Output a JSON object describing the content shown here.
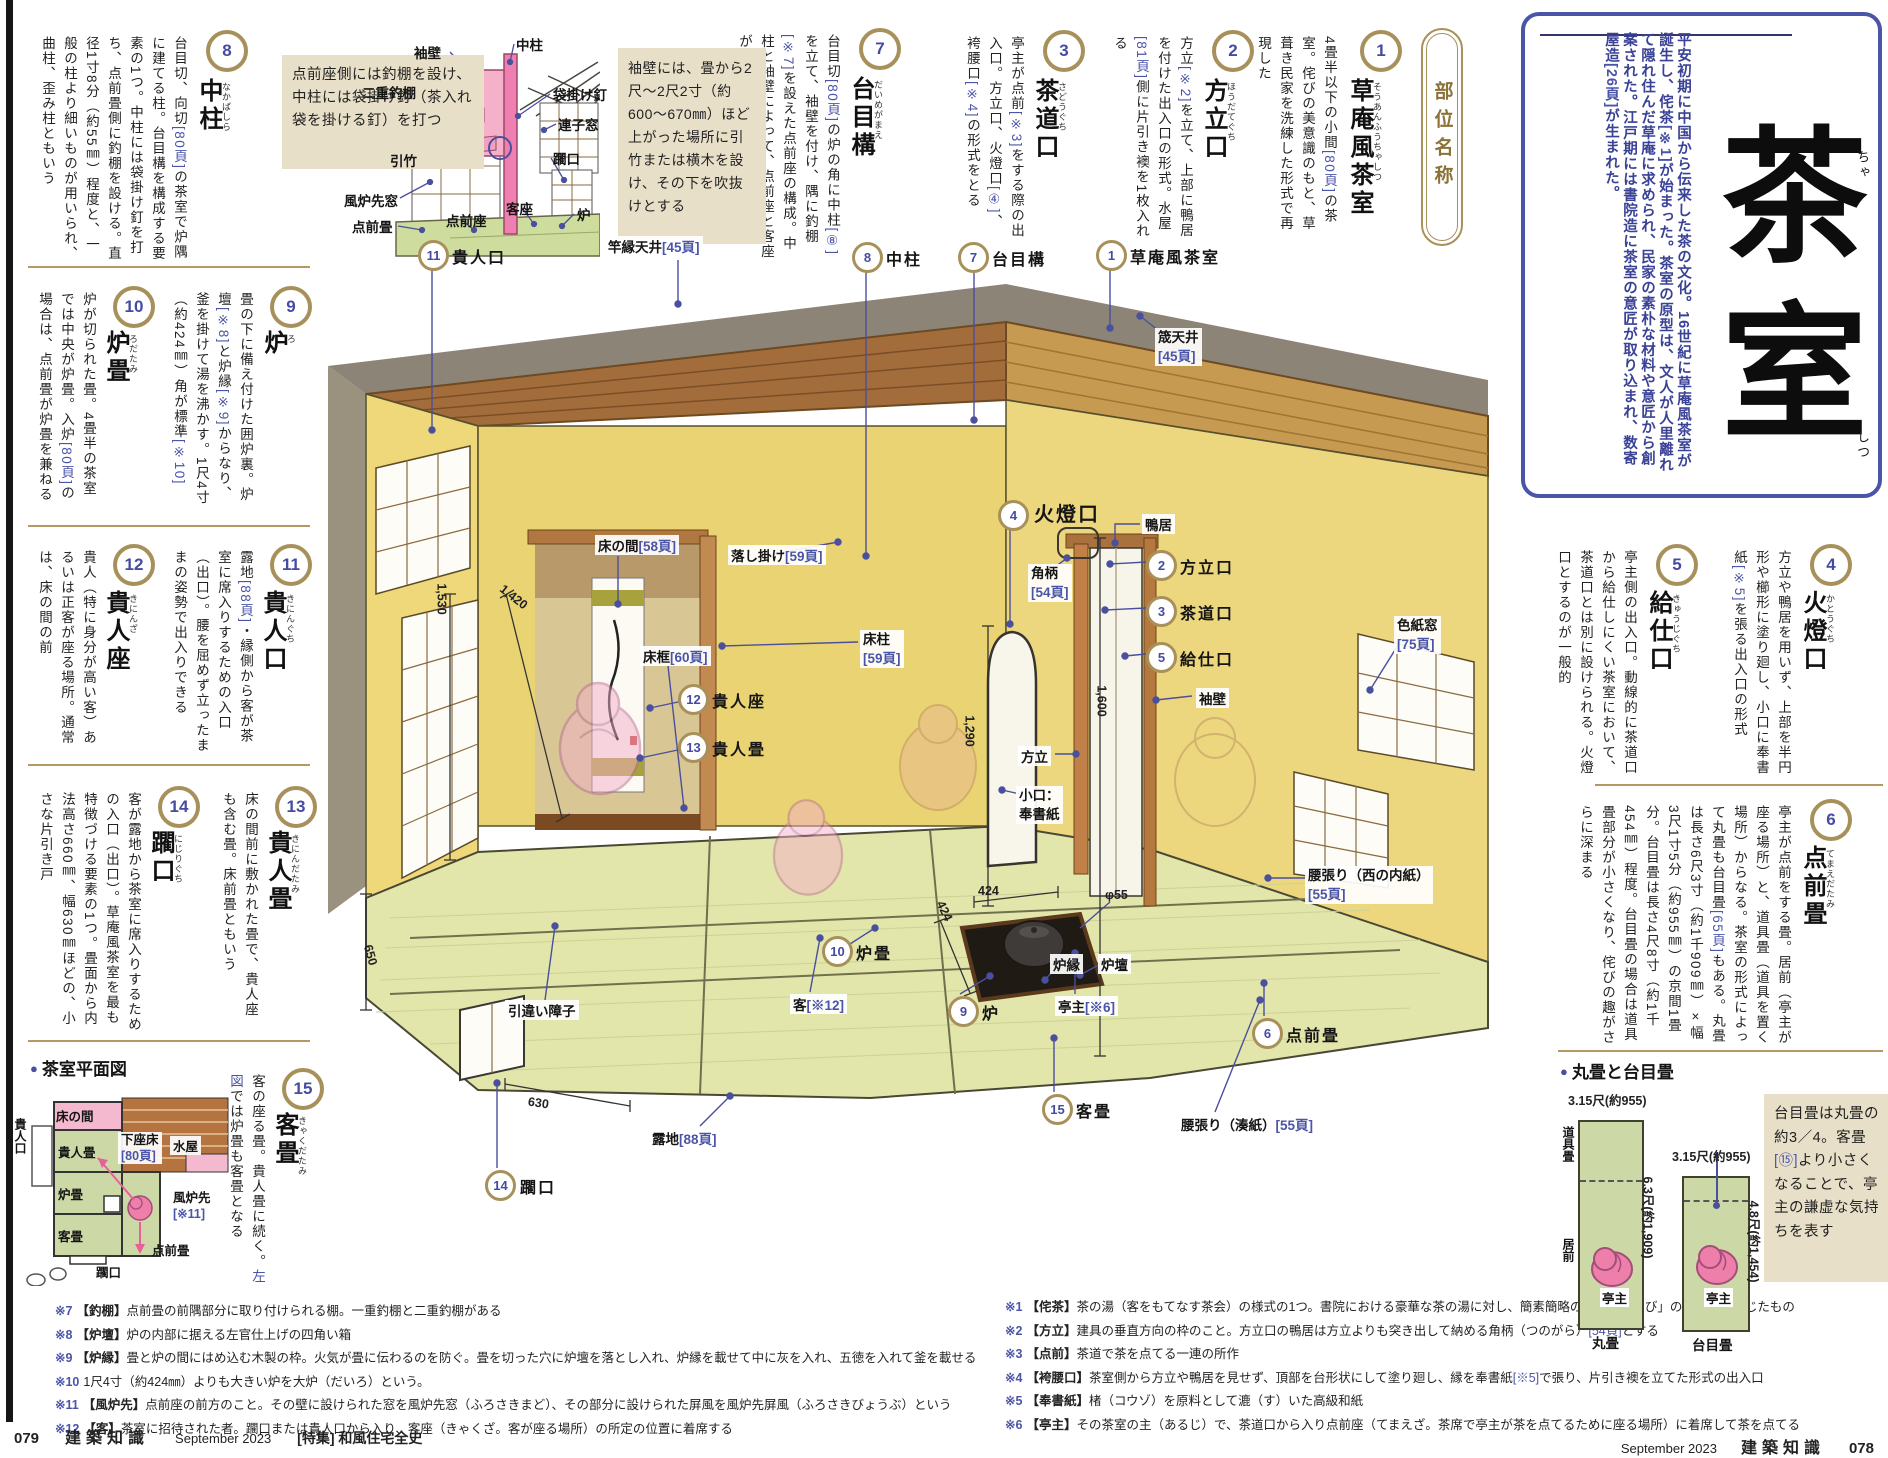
{
  "accent_words": [
    "左図"
  ],
  "header": {
    "badge": "部位名称",
    "title": "茶室",
    "title_kana_1": "ちゃ",
    "title_kana_2": "しつ",
    "intro": "平安初期に中国から伝来した茶の文化。16世紀に草庵風茶室が誕生し、侘茶[※1]が始まった。茶室の原型は、文人が人里離れて隠れ住んだ草庵に求められ、民家の素朴な材料や意匠から創案された。江戸期には書院造に茶室の意匠が取り込まれ、数寄屋造[26頁]が生まれた。"
  },
  "items": [
    {
      "num": "1",
      "name": "草庵風茶室",
      "kana": "そうあんふうちゃしつ",
      "body": "4畳半以下の小間[80頁]の茶室。侘びの美意識のもと、草葺き民家を洗練した形式で再現した"
    },
    {
      "num": "2",
      "name": "方立口",
      "kana": "ほうだてぐち",
      "body": "方立[※2]を立て、上部に鴨居を付けた出入口の形式。水屋[81頁]側に片引き襖を1枚入れる"
    },
    {
      "num": "3",
      "name": "茶道口",
      "kana": "さどうぐち",
      "body": "亭主が点前[※3]をする際の出入口。方立口、火燈口[④]、袴腰口[※4]の形式をとる"
    },
    {
      "num": "4",
      "name": "火燈口",
      "kana": "かとうぐち",
      "body": "方立や鴨居を用いず、上部を半円形や櫛形に塗り廻し、小口に奉書紙[※5]を張る出入口の形式"
    },
    {
      "num": "5",
      "name": "給仕口",
      "kana": "きゅうじぐち",
      "body": "亭主側の出入口。動線的に茶道口から給仕しにくい茶室において、茶道口とは別に設けられる。火燈口とするのが一般的"
    },
    {
      "num": "6",
      "name": "点前畳",
      "kana": "てまえだたみ",
      "body": "亭主が点前をする畳。居前（亭主が座る場所）と、道具畳（道具を置く場所）からなる。茶室の形式によって丸畳も台目畳[65頁]もある。丸畳は長さ6尺3寸（約1千909㎜）×幅3尺1寸5分（約955㎜）の京間1畳分。台目畳は長さ4尺8寸（約1千454㎜）程度。台目畳の場合は道具畳部分が小さくなり、侘びの趣がさらに深まる"
    },
    {
      "num": "7",
      "name": "台目構",
      "kana": "だいめがまえ",
      "body": "台目切[80頁]の炉の角に中柱[⑧]を立て、袖壁を付け、隅に釣棚[※7]を設えた点前座の構成。中柱と袖壁によって、点前座と客座が緩やかに隔てられる"
    },
    {
      "num": "8",
      "name": "中柱",
      "kana": "なかばしら",
      "body": "台目切、向切[80頁]の茶室で炉隅に建てる柱。台目構を構成する要素の1つ。中柱には袋掛け釘を打ち、点前畳側に釣棚を設ける。直径1寸8分（約55㎜）程度と、一般の柱より細いものが用いられ、曲柱、歪み柱ともいう"
    },
    {
      "num": "9",
      "name": "炉",
      "kana": "ろ",
      "body": "畳の下に備え付けた囲炉裏。炉壇[※8]と炉縁[※9]からなり、釜を掛けて湯を沸かす。1尺4寸（約424㎜）角が標準[※10]"
    },
    {
      "num": "10",
      "name": "炉畳",
      "kana": "ろだたみ",
      "body": "炉が切られた畳。4畳半の茶室では中央が炉畳。入炉[80頁]の場合は、点前畳が炉畳を兼ねる"
    },
    {
      "num": "11",
      "name": "貴人口",
      "kana": "きにんぐち",
      "body": "露地[88頁]・縁側から客が茶室に席入りするための入口（出口）。腰を屈めず立ったままの姿勢で出入りできる"
    },
    {
      "num": "12",
      "name": "貴人座",
      "kana": "きにんざ",
      "body": "貴人（特に身分が高い客）あるいは正客が座る場所。通常は、床の間の前"
    },
    {
      "num": "13",
      "name": "貴人畳",
      "kana": "きにんだたみ",
      "body": "床の間前に敷かれた畳で、貴人座も含む畳。床前畳ともいう"
    },
    {
      "num": "14",
      "name": "躙口",
      "kana": "にじりぐち",
      "body": "客が露地から茶室に席入りするための入口（出口）。草庵風茶室を最も特徴づける要素の1つ。畳面から内法高さ660㎜、幅630㎜ほどの、小さな片引き戸"
    },
    {
      "num": "15",
      "name": "客畳",
      "kana": "きゃくだたみ",
      "body": "客の座る畳。貴人畳に続く。左図では炉畳も客畳となる"
    }
  ],
  "notes": {
    "sode": "袖壁には、畳から2尺〜2尺2寸（約600〜670㎜）ほど上がった場所に引竹または横木を設け、その下を吹抜けとする",
    "tsuridana": "点前座側には釣棚を設け、中柱には袋掛け釘（茶入れ袋を掛ける釘）を打つ",
    "daime": "台目畳は丸畳の約3／4。客畳[⑮]より小さくなることで、亭主の謙虚な気持ちを表す"
  },
  "mini": {
    "labels": {
      "sodekabe": "袖壁",
      "nakabashira": "中柱",
      "nijyu_tsuridana": "二重釣棚",
      "fukurokake_kugi": "袋掛け釘",
      "renjimado": "連子窓",
      "nijiriguchi": "躙口",
      "hikitake": "引竹",
      "furosaki_mado": "風炉先窓",
      "temaedatami": "点前畳",
      "temaeza": "点前座",
      "kyakuza": "客座",
      "ro": "炉"
    }
  },
  "main": {
    "labels": {
      "kinin_guchi": "貴人口",
      "saobuchi_tenjo": "竿縁天井[45頁]",
      "nakabashira": "中柱",
      "daimegamae": "台目構",
      "soanfu": "草庵風茶室",
      "osa_tenjo": "筬天井",
      "osa_ref": "[45頁]",
      "tokonoma": "床の間[58頁]",
      "otoshigake": "落し掛け[59頁]",
      "tokobashira": "床柱",
      "tokobashira_ref": "[59頁]",
      "tokogamachi": "床框[60頁]",
      "kininza": "貴人座",
      "kinindatami": "貴人畳",
      "hikichigai": "引違い障子",
      "kyaku": "客[※12]",
      "rodatami": "炉畳",
      "ro": "炉",
      "robuchi": "炉縁",
      "rodan": "炉壇",
      "teishu": "亭主[※6]",
      "nijiriguchi": "躙口",
      "roji": "露地[88頁]",
      "kyakudatami": "客畳",
      "koshibari_minato": "腰張り（湊紙）[55頁]",
      "temaedatami": "点前畳",
      "koshibari_nishi": "腰張り（西の内紙）",
      "koshibari_nishi_ref": "[55頁]",
      "shikishimado": "色紙窓",
      "shikishimado_ref": "[75頁]",
      "katoguchi": "火燈口",
      "kamoi": "鴨居",
      "tsunogara": "角柄",
      "tsunogara_ref": "[54頁]",
      "hodateguchi": "方立口",
      "sadoguchi": "茶道口",
      "kyujiguchi": "給仕口",
      "sodekabe": "袖壁",
      "hodate": "方立",
      "koguchi": "小口：",
      "koguchi2": "奉書紙",
      "dim_1420": "1,420",
      "dim_1530": "1,530",
      "dim_650": "650",
      "dim_1290": "1,290",
      "dim_1600": "1,600",
      "dim_424a": "424",
      "dim_424b": "424",
      "dim_phi55": "φ55",
      "dim_630": "630"
    }
  },
  "plan": {
    "bullet": "●",
    "title": "茶室平面図",
    "labels": {
      "kinin_guchi": "貴人口",
      "tokonoma": "床の間",
      "kinindatami": "貴人畳",
      "gezadoko": "下座床",
      "gezadoko_ref": "[80頁]",
      "mizuya": "水屋",
      "rodatami": "炉畳",
      "furosaki": "風炉先",
      "furosaki_ref": "[※11]",
      "kyakudatami": "客畳",
      "temaedatami": "点前畳",
      "nijiriguchi": "躙口"
    }
  },
  "tatami": {
    "bullet": "●",
    "title": "丸畳と台目畳",
    "w1": "3.15尺(約955)",
    "h1": "6.3尺(約1,909)",
    "w2": "3.15尺(約955)",
    "h2": "4.8尺(約1,454)",
    "dougu": "道具畳",
    "imae": "居前",
    "teishu1": "亭主",
    "teishu2": "亭主",
    "cap1": "丸畳",
    "cap2": "台目畳"
  },
  "footnotes_left": [
    {
      "mark": "※7",
      "text": "【釣棚】点前畳の前隅部分に取り付けられる棚。一重釣棚と二重釣棚がある"
    },
    {
      "mark": "※8",
      "text": "【炉壇】炉の内部に据える左官仕上げの四角い箱"
    },
    {
      "mark": "※9",
      "text": "【炉縁】畳と炉の間にはめ込む木製の枠。火気が畳に伝わるのを防ぐ。畳を切った穴に炉壇を落とし入れ、炉縁を載せて中に灰を入れ、五徳を入れて釜を載せる"
    },
    {
      "mark": "※10",
      "text": "1尺4寸（約424㎜）よりも大きい炉を大炉（だいろ）という。"
    },
    {
      "mark": "※11",
      "text": "【風炉先】点前座の前方のこと。その壁に設けられた窓を風炉先窓（ふろさきまど）、その部分に設けられた屏風を風炉先屏風（ふろさきびょうぶ）という"
    },
    {
      "mark": "※12",
      "text": "【客】茶室に招待された者。躙口または貴人口から入り、客座（きゃくざ。客が座る場所）の所定の位置に着席する"
    }
  ],
  "footnotes_right": [
    {
      "mark": "※1",
      "text": "【侘茶】茶の湯（客をもてなす茶会）の様式の1つ。書院における豪華な茶の湯に対し、簡素簡略の「侘（わ）び」の精神を重んじたもの"
    },
    {
      "mark": "※2",
      "text": "【方立】建具の垂直方向の枠のこと。方立口の鴨居は方立よりも突き出して納める角柄（つのがら）[54頁]とする"
    },
    {
      "mark": "※3",
      "text": "【点前】茶道で茶を点てる一連の所作"
    },
    {
      "mark": "※4",
      "text": "【袴腰口】茶室側から方立や鴨居を見せず、頂部を台形状にして塗り廻し、縁を奉書紙[※5]で張り、片引き襖を立てた形式の出入口"
    },
    {
      "mark": "※5",
      "text": "【奉書紙】楮（コウゾ）を原料として漉（す）いた高級和紙"
    },
    {
      "mark": "※6",
      "text": "【亭主】その茶室の主（あるじ）で、茶道口から入り点前座（てまえざ。茶席で亭主が茶を点てるために座る場所）に着席して茶を点てる"
    }
  ],
  "footer": {
    "left_page": "079",
    "left_mag": "建築知識",
    "left_date": "September 2023",
    "left_feature": "[特集] 和風住宅全史",
    "right_date": "September 2023",
    "right_mag": "建築知識",
    "right_page": "078"
  }
}
